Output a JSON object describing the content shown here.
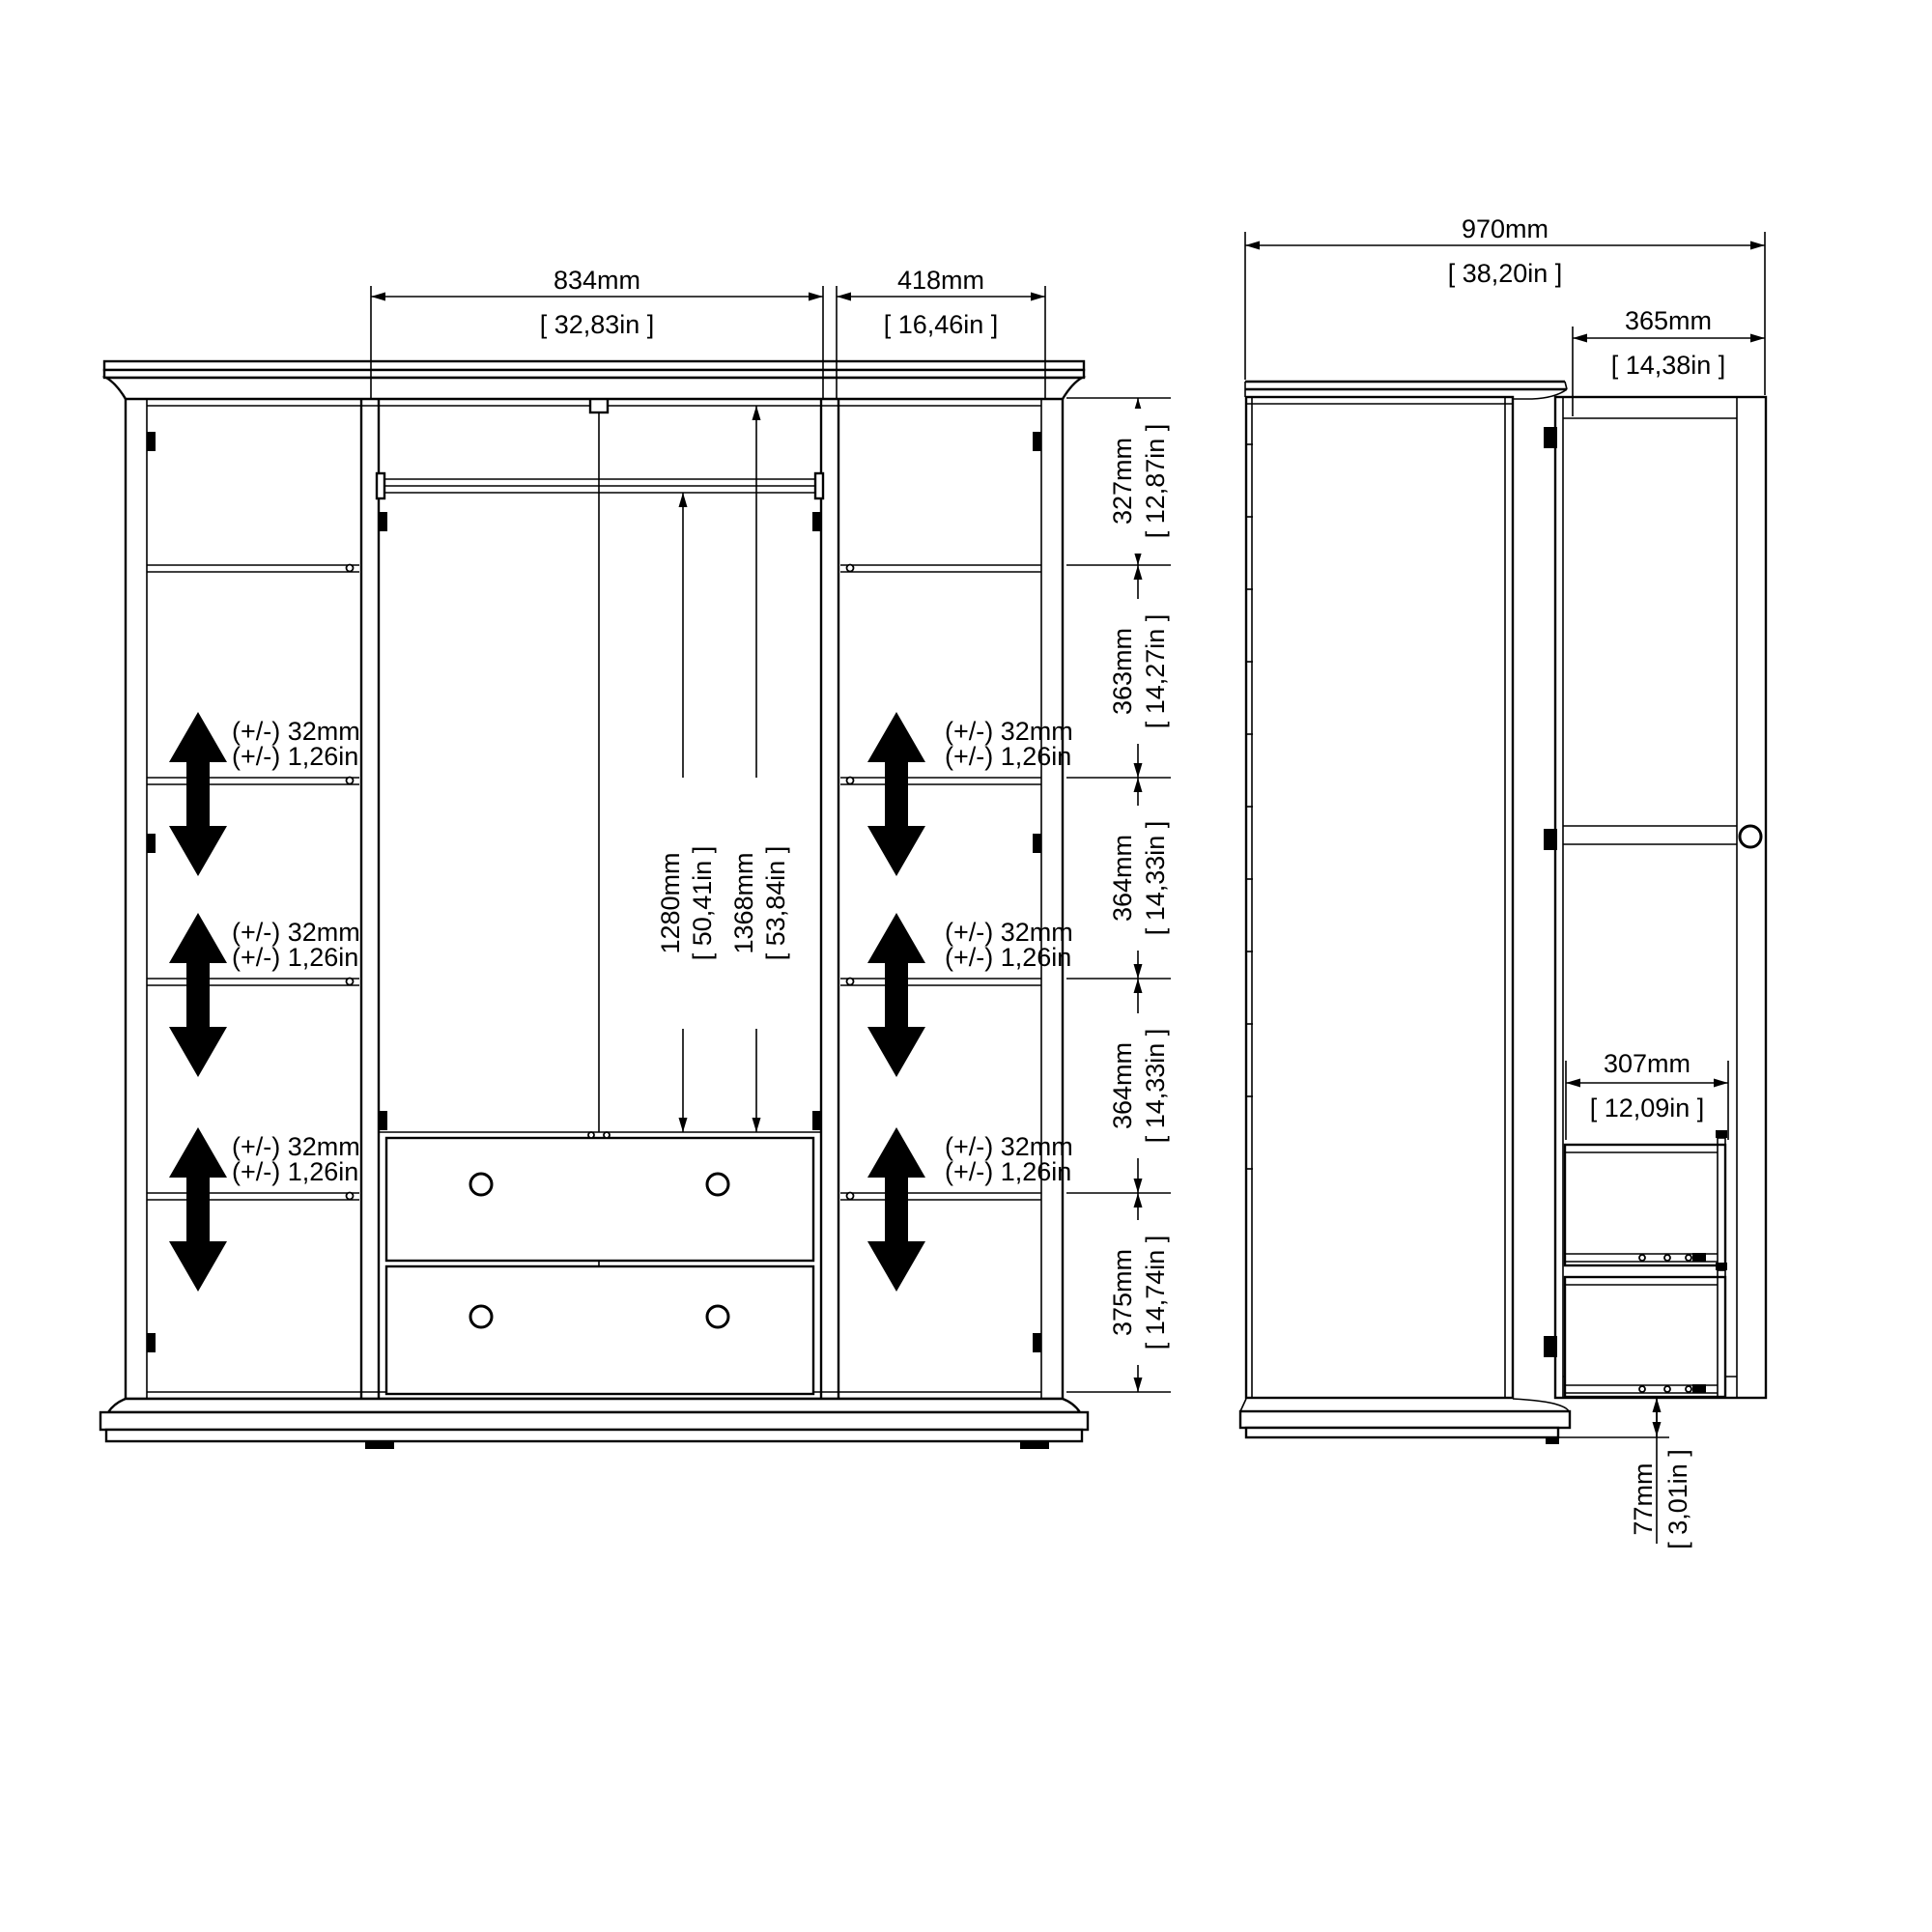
{
  "front_view": {
    "top_dims": [
      {
        "mm": "834mm",
        "in": "[ 32,83in ]"
      },
      {
        "mm": "418mm",
        "in": "[ 16,46in ]"
      }
    ],
    "height_dims": [
      {
        "mm": "327mm",
        "in": "[ 12,87in ]"
      },
      {
        "mm": "363mm",
        "in": "[ 14,27in ]"
      },
      {
        "mm": "364mm",
        "in": "[ 14,33in ]"
      },
      {
        "mm": "364mm",
        "in": "[ 14,33in ]"
      },
      {
        "mm": "375mm",
        "in": "[ 14,74in ]"
      }
    ],
    "rail_height_dim": {
      "mm": "1280mm",
      "in": "[ 50,41in ]"
    },
    "interior_height_dim": {
      "mm": "1368mm",
      "in": "[ 53,84in ]"
    },
    "tolerance": {
      "mm": "(+/-) 32mm",
      "in": "(+/-) 1,26in"
    }
  },
  "side_view": {
    "total_depth_dim": {
      "mm": "970mm",
      "in": "[ 38,20in ]"
    },
    "door_width_dim": {
      "mm": "365mm",
      "in": "[ 14,38in ]"
    },
    "drawer_extension_dim": {
      "mm": "307mm",
      "in": "[ 12,09in ]"
    },
    "plinth_height_dim": {
      "mm": "77mm",
      "in": "[ 3,01in ]"
    }
  },
  "colors": {
    "line": "#000000",
    "background": "#ffffff"
  }
}
